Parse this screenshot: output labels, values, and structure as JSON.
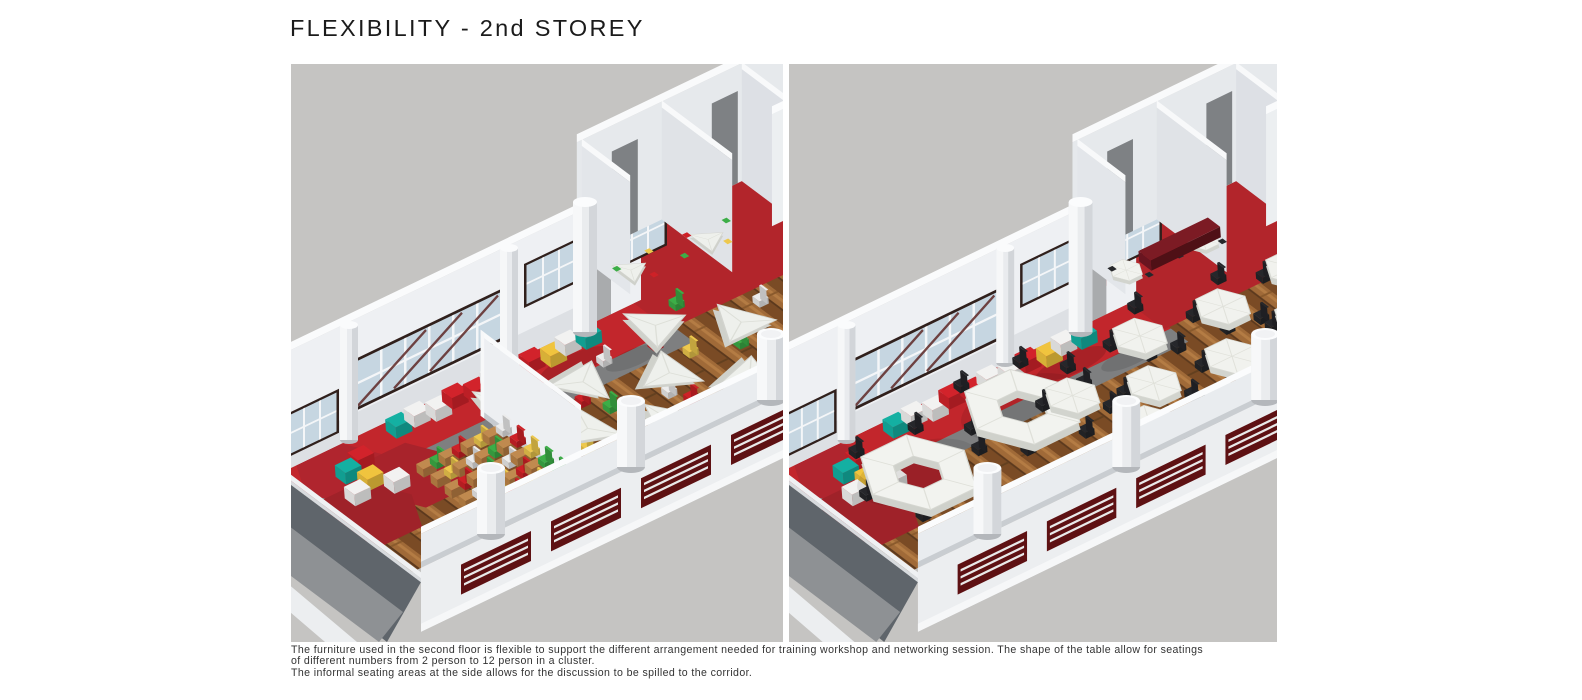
{
  "title": "FLEXIBILITY - 2nd STOREY",
  "caption": {
    "lines": [
      "The furniture used in the second floor is flexible to support the different arrangement needed for training workshop and networking session. The shape of the table allow for seatings",
      "of different numbers from 2 person to 12 person in a cluster.",
      "The informal seating areas at the side allows for the discussion to be spilled to the corridor."
    ]
  },
  "colors": {
    "page_background": "#ffffff",
    "render_background": "#c5c4c2",
    "carpet_red": "#c2262c",
    "rug_red_dark": "#a8232b",
    "wood_floor": "#8f5e30",
    "wall_white": "#eef0f3",
    "concrete_gray": "#7e7f80",
    "table_white": "#f1f2ee",
    "ottoman_red": "#d2232b",
    "ottoman_yellow": "#f0c43e",
    "ottoman_teal": "#14b0a2",
    "ottoman_white": "#f2f2f1",
    "chair_green": "#3cae47",
    "chair_red": "#ce2127",
    "chair_yellow": "#edc84e",
    "chair_black": "#26272b",
    "window_frame": "#30201c",
    "window_glass": "#c6d6e1",
    "louver_maroon": "#5e1113",
    "title_text": "#1b1b1b",
    "caption_text": "#333333"
  }
}
